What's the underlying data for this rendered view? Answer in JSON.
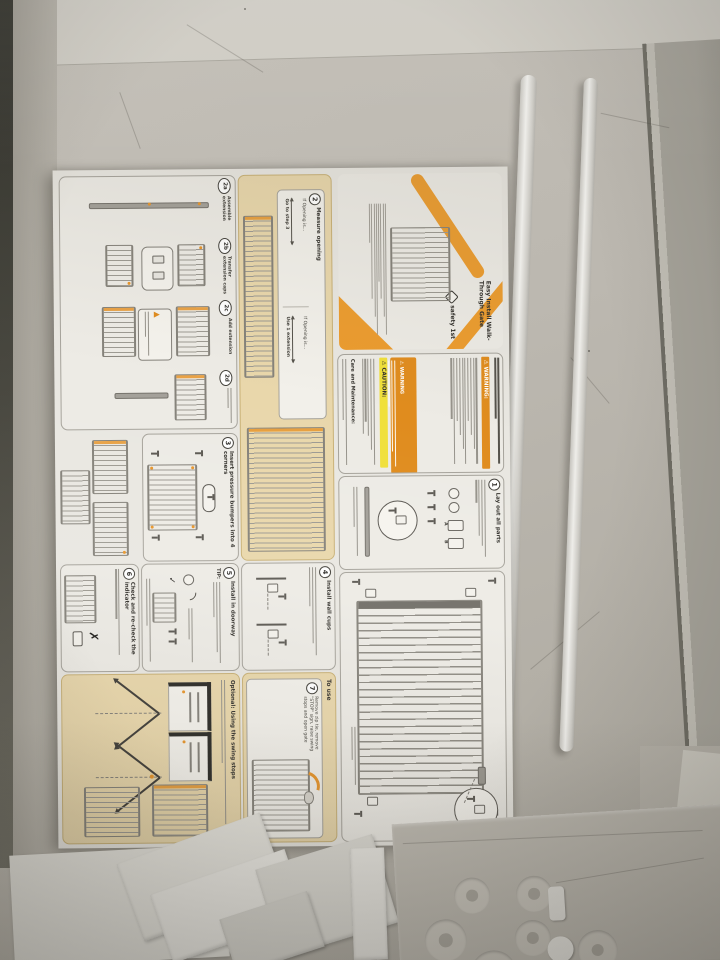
{
  "colors": {
    "accent_orange": "#e8952a",
    "caution_yellow": "#f0e03a",
    "tan_panel": "#e9d7ab",
    "paper": "#e9e7e1"
  },
  "manual": {
    "brand": "safety 1st",
    "cover_title": "Easy Install Walk-Through Gate",
    "warnings": {
      "warning_label": "⚠ WARNING:",
      "warning_box_label": "⚠ WARNING",
      "caution_label": "⚠ CAUTION:",
      "care_label": "Care and Maintenance:"
    },
    "step1": {
      "num": "1",
      "title": "Lay out all parts",
      "part_a": "A",
      "part_b": "B"
    },
    "step2": {
      "num": "2",
      "title": "Measure opening",
      "if_opening": "If Opening is...",
      "goto3": "Go to step 3",
      "if_opening2": "If Opening is...",
      "use_ext": "Use 1 extension"
    },
    "step2a": {
      "num": "2a",
      "title": "Assemble extension"
    },
    "step2b": {
      "num": "2b",
      "title": "Transfer extension caps"
    },
    "step2c": {
      "num": "2c",
      "title": "Add extension"
    },
    "step2d": {
      "num": "2d"
    },
    "step3": {
      "num": "3",
      "title": "Insert pressure bumpers into 4 corners"
    },
    "step4": {
      "num": "4",
      "title": "Install wall cups"
    },
    "step5": {
      "num": "5",
      "title": "Install in doorway",
      "tip_label": "TIP:",
      "check_mark": "✓"
    },
    "step6": {
      "num": "6",
      "title": "Check and re-check the indicator",
      "x_mark": "✗"
    },
    "step7": {
      "num": "7",
      "tab_label": "To use",
      "title": "Remove zip tie, remove \"STOP\" sign, raise swing stops and open gate"
    },
    "optional_title": "Optional: Using the swing stops"
  }
}
